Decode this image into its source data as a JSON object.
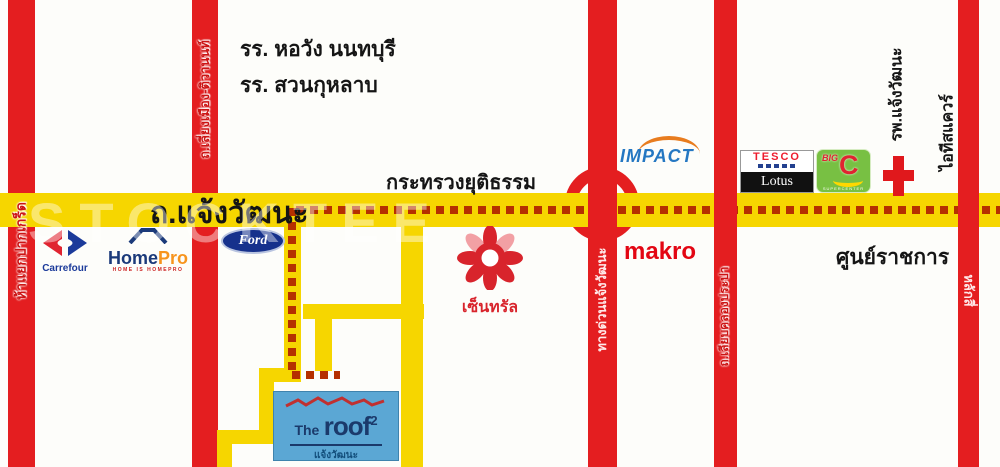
{
  "watermark": "STOCKTEE",
  "main_road": {
    "label": "ถ.แจ้งวัฒนะ"
  },
  "road_names": {
    "pakkret": "ห้าแยกปากเกร็ด",
    "liang_mueang": "ถ.เลี่ยงเมือง-ติวานนท์",
    "tollway": "ทางด่วนแจ้งวัฒนะ",
    "khlong_prapa": "ถ.เลียบคลองประปา",
    "laksi": "หลักสี่"
  },
  "places": {
    "school_horwang": "รร. หอวัง นนทบุรี",
    "school_suankularb": "รร. สวนกุหลาบ",
    "ministry_justice": "กระทรวงยุติธรรม",
    "government_center": "ศูนย์ราชการ",
    "hospital": "รพ.แจ้งวัฒนะ",
    "it_square": "ไอทีสแควร์"
  },
  "logos": {
    "carrefour": {
      "label": "Carrefour"
    },
    "homepro": {
      "home": "Home",
      "pro": "Pro",
      "tagline": "HOME IS HOMEPRO"
    },
    "ford": {
      "label": "Ford"
    },
    "impact": {
      "label": "IMPACT"
    },
    "tesco_lotus": {
      "tesco": "TESCO",
      "lotus": "Lotus"
    },
    "big_c": {
      "big": "BIG",
      "c": "C",
      "sub": "SUPERCENTER"
    },
    "central": {
      "label": "เซ็นทรัล"
    },
    "makro": {
      "label": "makro"
    },
    "the_roof": {
      "the": "The",
      "roof": "roof",
      "sup": "2",
      "sub": "แจ้งวัฒนะ"
    }
  },
  "colors": {
    "road_red": "#e41e20",
    "road_yellow": "#f6d600",
    "route_dash": "#b53000"
  }
}
